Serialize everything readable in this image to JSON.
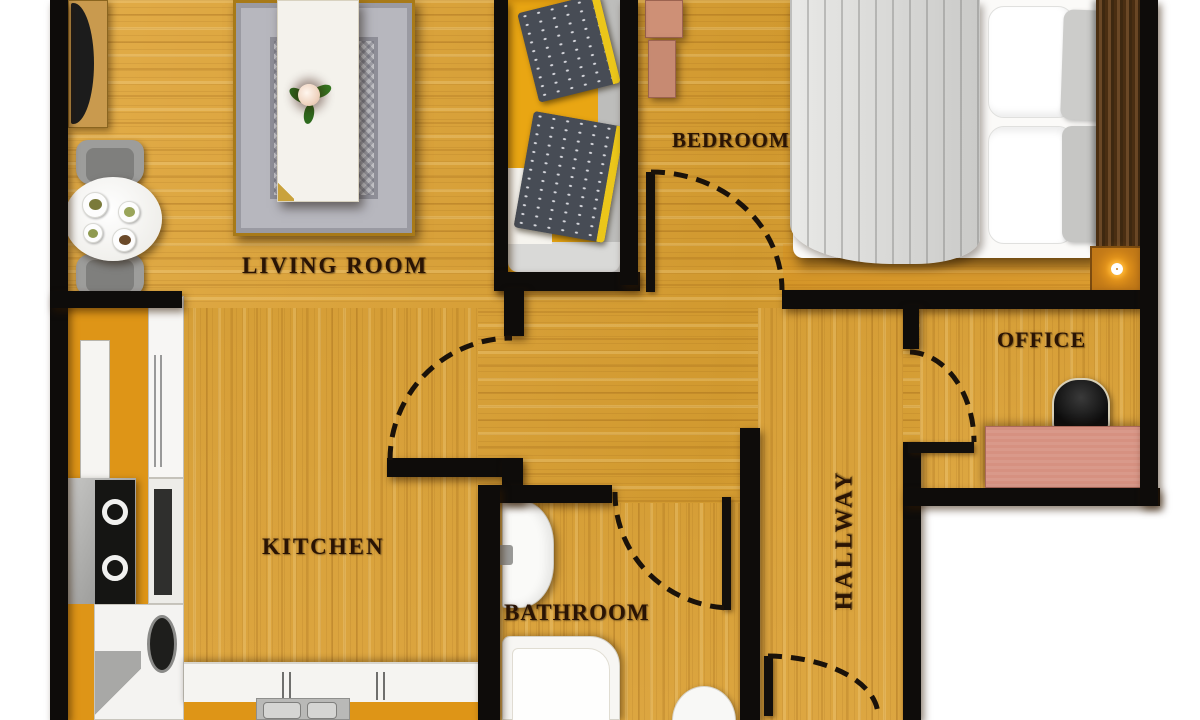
{
  "title": "Apartment floor plan",
  "labels": {
    "living_room": "LIVING ROOM",
    "bedroom": "BEDROOM",
    "kitchen": "KITCHEN",
    "bathroom": "BATHROOM",
    "hallway": "HALLWAY",
    "office": "OFFICE"
  },
  "colors": {
    "floor_wood": "#D9A23C",
    "wall_black": "#0E0C0A",
    "label_text": "#2A1404",
    "sofa_yellow": "#E9A613",
    "pillow_navy": "#474C55",
    "pillow_trim_yellow": "#EBC61A",
    "cabinet_orange": "#DE9517",
    "furniture_salmon": "#D69181",
    "rug_gray": "#C2C2C6",
    "bedding_gray": "#D7D7D5",
    "headboard_brown": "#4A2E12",
    "lamp_glow_orange": "#FFAA1E",
    "outside_white": "#FFFFFF"
  },
  "furniture": [
    "tv-stand",
    "tv",
    "dining-table",
    "dining-chair",
    "plates",
    "area-rug",
    "coffee-table",
    "flower-centerpiece",
    "sofa",
    "throw-pillow",
    "dresser",
    "double-bed",
    "duvet",
    "bed-pillow",
    "headboard",
    "nightstand",
    "lamp",
    "office-chair",
    "office-desk",
    "bathroom-sink",
    "faucet",
    "bathtub",
    "toilet",
    "kitchen-cabinet",
    "fridge",
    "stove",
    "oven",
    "washing-machine",
    "kitchen-counter",
    "kitchen-sink"
  ],
  "doors": [
    "kitchen-door-arc",
    "bedroom-door-arc",
    "bathroom-door-arc",
    "office-door-arc",
    "entry-door-arc"
  ]
}
